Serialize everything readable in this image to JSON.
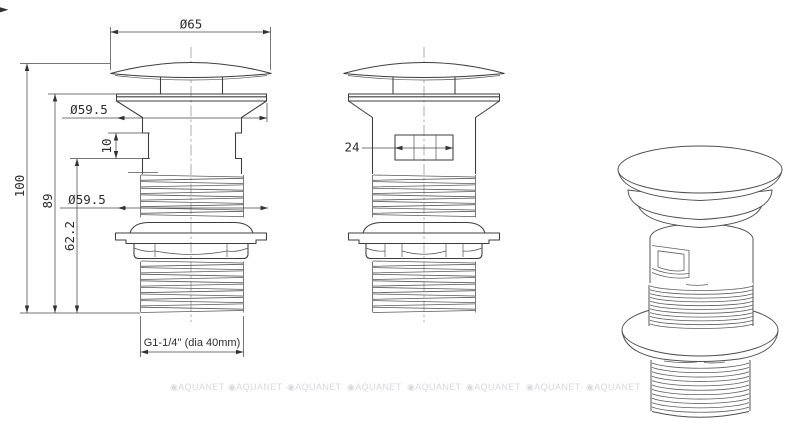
{
  "drawing": {
    "dimensions": {
      "cap_diameter": "Ø65",
      "collar_diameter": "Ø59.5",
      "overall_height": "100",
      "height_below_collar": "89",
      "height_below_slot": "62.2",
      "slot_height": "10",
      "slot_width": "24",
      "washer_diameter": "Ø59.5",
      "thread_spec": "G1-1/4'' (dia 40mm)"
    },
    "watermark": {
      "label": "◉AQUANET",
      "count": 8
    }
  }
}
